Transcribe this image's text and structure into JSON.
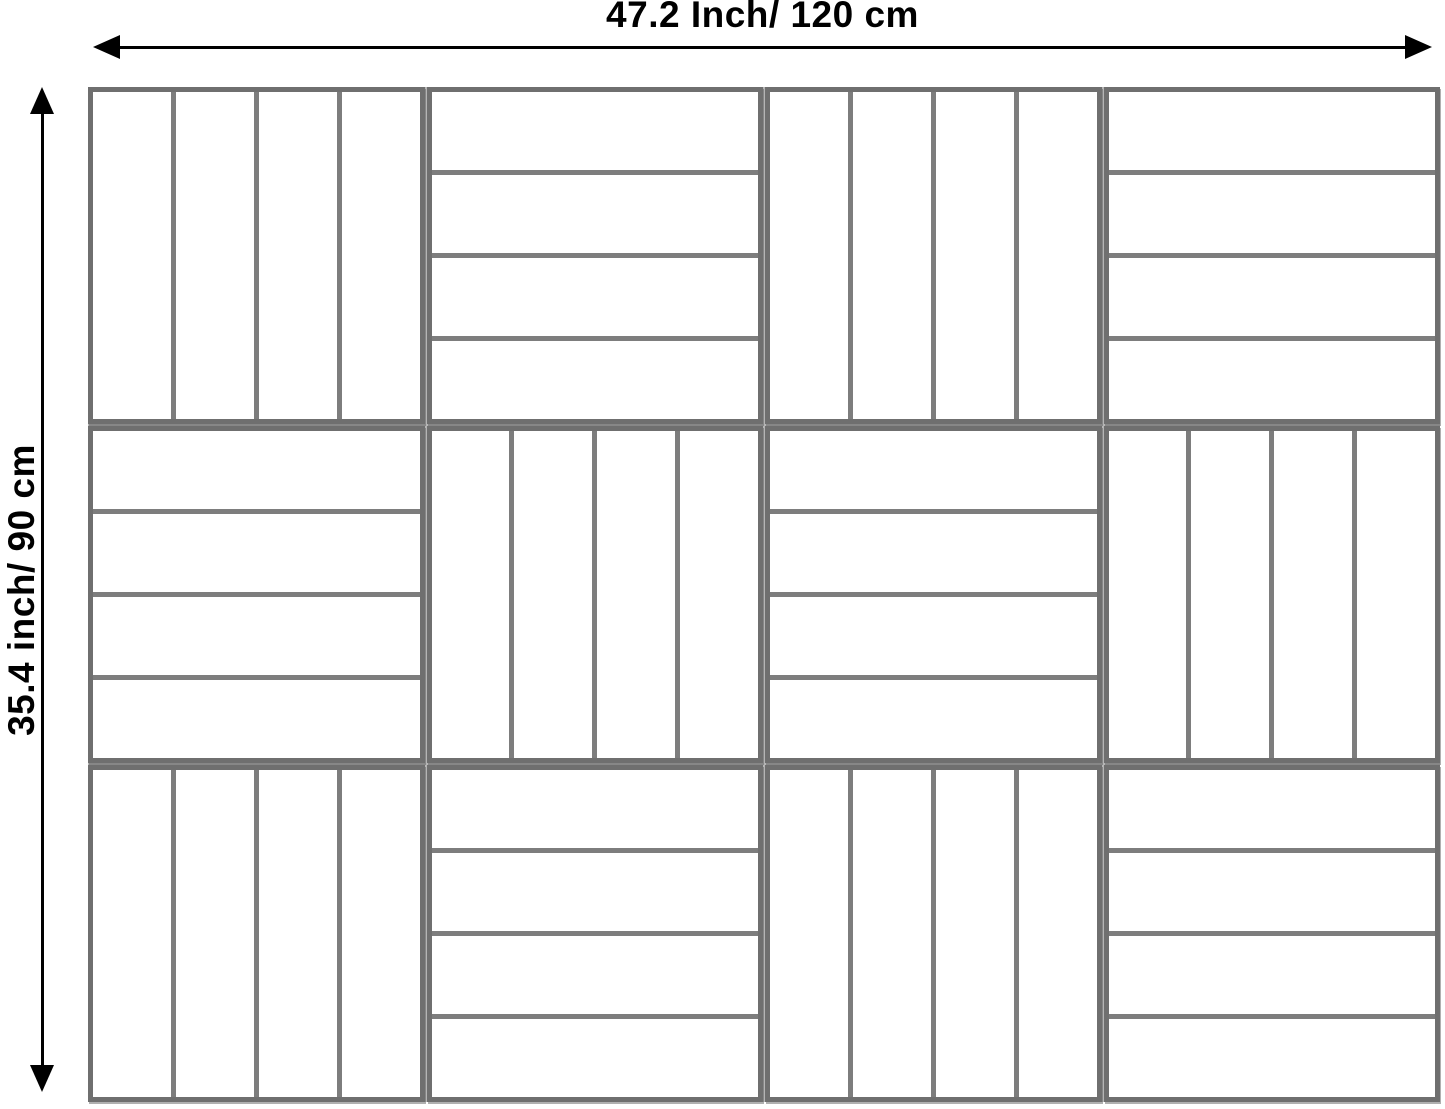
{
  "dimensions": {
    "width_label": "47.2 Inch/ 120 cm",
    "height_label": "35.4 inch/ 90 cm"
  },
  "colors": {
    "arrow": "#000000",
    "tile_border": "#6f6f6f",
    "slat_line": "#7d7d7d",
    "tile_fill": "#ffffff",
    "grid_gap": "#b5b5b5",
    "page_background": "#ffffff"
  },
  "tiles": {
    "rows": 3,
    "cols": 4,
    "slats_per_tile": 4,
    "pattern": [
      [
        "vertical",
        "horizontal",
        "vertical",
        "horizontal"
      ],
      [
        "horizontal",
        "vertical",
        "horizontal",
        "vertical"
      ],
      [
        "vertical",
        "horizontal",
        "vertical",
        "horizontal"
      ]
    ]
  }
}
